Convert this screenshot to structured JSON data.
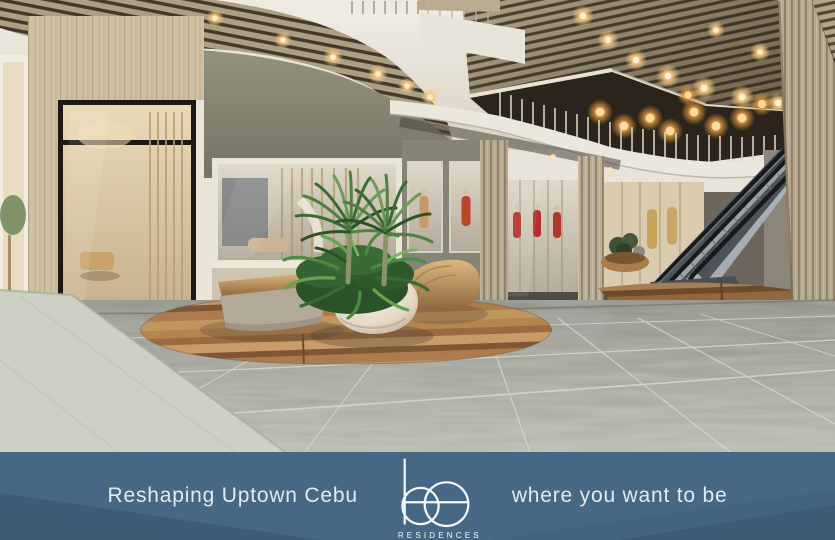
{
  "banner": {
    "tagline_left": "Reshaping Uptown Cebu",
    "logo": {
      "text": "be",
      "subtext": "RESIDENCES"
    },
    "tagline_right": "where you want to be",
    "background_color": "#466884",
    "wedge_color": "#3a5a72",
    "text_color": "#e3eaef"
  },
  "scene": {
    "colors": {
      "ceiling_white": "#ece7dd",
      "wood_slat": "#ab9d80",
      "travertine": "#cdbc9d",
      "gray_wall": "#8a877c",
      "warm_light": "#ffd89a",
      "floor_tile": "#a3a49b",
      "floor_light_tile": "#ced2c6",
      "wood_floor_inlay": "#b08050",
      "foliage_green": "#4c8140",
      "escalator_metal": "#b9bfc4",
      "planter_pot": "#efe7db"
    }
  }
}
